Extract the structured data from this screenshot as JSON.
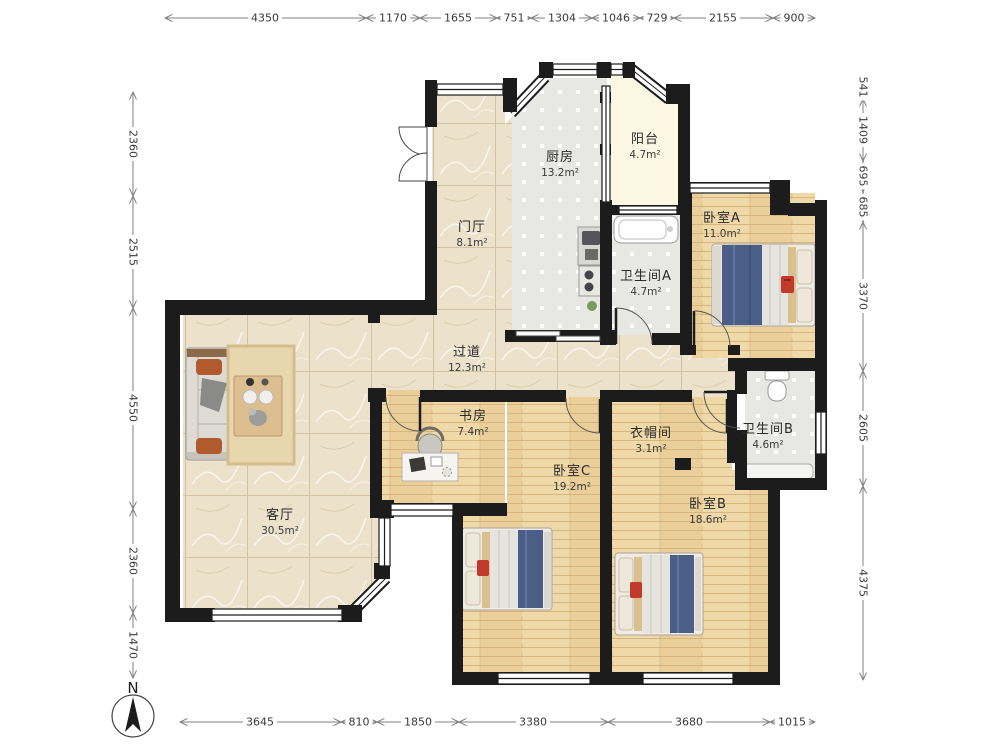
{
  "rooms": [
    {
      "id": "kitchen",
      "name": "厨房",
      "area": "13.2m²"
    },
    {
      "id": "balcony",
      "name": "阳台",
      "area": "4.7m²"
    },
    {
      "id": "foyer",
      "name": "门厅",
      "area": "8.1m²"
    },
    {
      "id": "bedroom-a",
      "name": "卧室A",
      "area": "11.0m²"
    },
    {
      "id": "bathroom-a",
      "name": "卫生间A",
      "area": "4.7m²"
    },
    {
      "id": "hallway",
      "name": "过道",
      "area": "12.3m²"
    },
    {
      "id": "study",
      "name": "书房",
      "area": "7.4m²"
    },
    {
      "id": "cloakroom",
      "name": "衣帽间",
      "area": "3.1m²"
    },
    {
      "id": "bathroom-b",
      "name": "卫生间B",
      "area": "4.6m²"
    },
    {
      "id": "bedroom-c",
      "name": "卧室C",
      "area": "19.2m²"
    },
    {
      "id": "bedroom-b",
      "name": "卧室B",
      "area": "18.6m²"
    },
    {
      "id": "living-room",
      "name": "客厅",
      "area": "30.5m²"
    }
  ],
  "dimensions": {
    "top": [
      "4350",
      "1170",
      "1655",
      "751",
      "1304",
      "1046",
      "729",
      "2155",
      "900"
    ],
    "left": [
      "2360",
      "2515",
      "4550",
      "2360",
      "1470"
    ],
    "right": [
      "541",
      "1409",
      "695",
      "685",
      "3370",
      "2605",
      "4375"
    ],
    "bottom": [
      "3645",
      "810",
      "1850",
      "3380",
      "3680",
      "1015"
    ]
  },
  "compass": {
    "label": "N"
  },
  "colors": {
    "wall": "#1c1c1c",
    "marble_floor": "#ece2cb",
    "wood_floor": "#f0d9a9",
    "tile_floor": "#e7e7e4",
    "balcony_floor": "#fbf7e2",
    "bed_blanket_blue": "#4b5e88",
    "pillow_orange": "#b05a2d",
    "bag_red": "#c0392b"
  }
}
